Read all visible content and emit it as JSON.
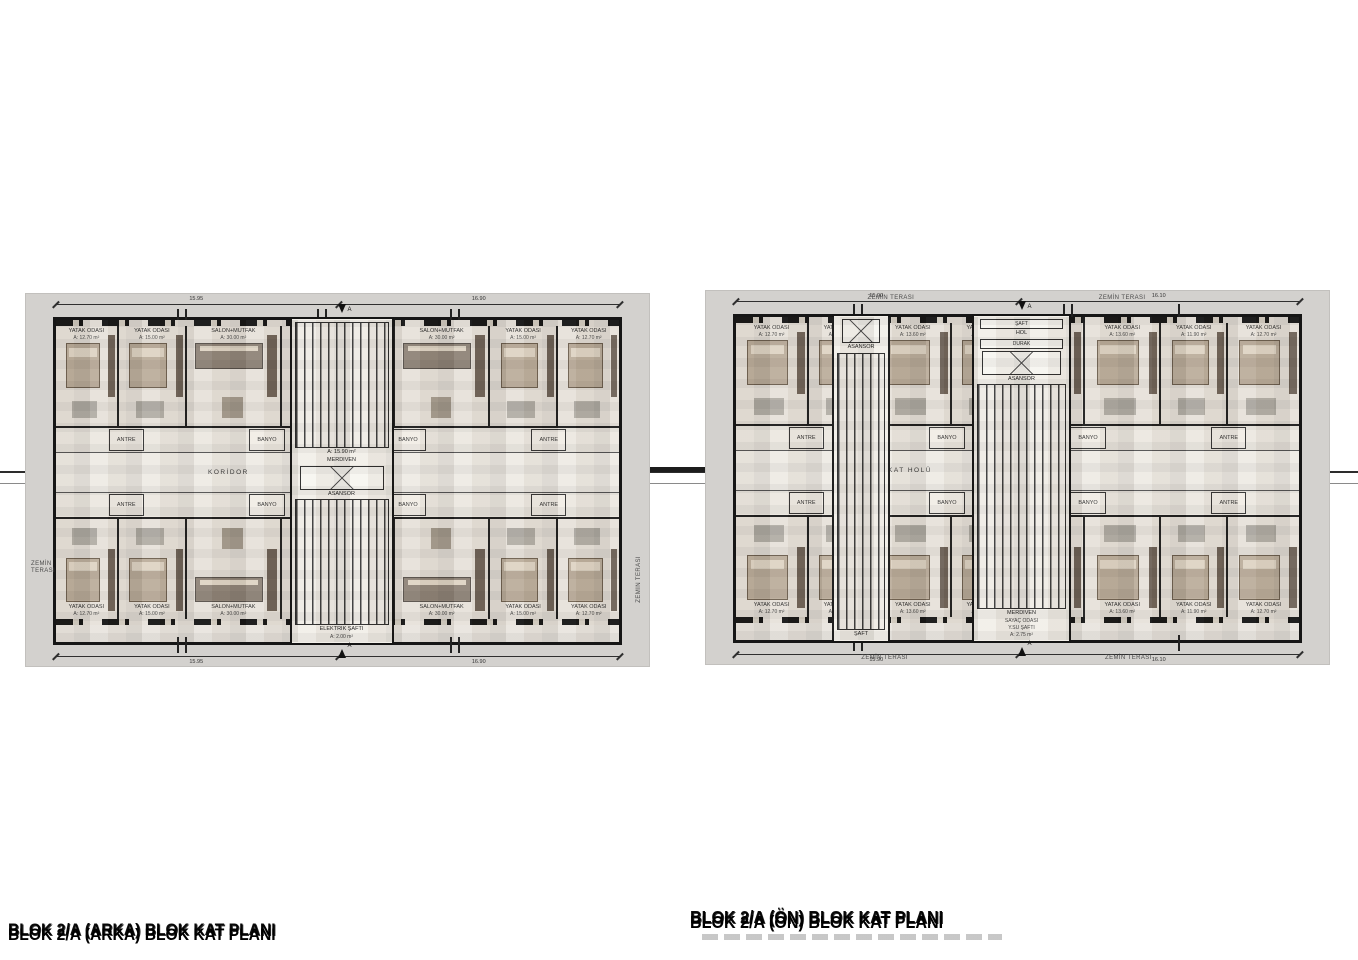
{
  "drawing": {
    "titles": {
      "left": "BLOK 2/A (ARKA) BLOK KAT PLANI",
      "right": "BLOK 2/A (ÖN) BLOK KAT PLANI"
    },
    "palette": {
      "panel_gray": "#d3d1ce",
      "building_fill": "#e9e5df",
      "wall_black": "#161616",
      "furniture_wood": "#bcae9c",
      "furniture_dark": "#6e6257",
      "rug_gray": "#a8a49c"
    }
  },
  "plan_left": {
    "corridor_label": "KORİDOR",
    "section_mark": "A",
    "terrace_left": "ZEMİN TERASI",
    "terrace_right": "ZEMİN TERASI",
    "dims_top": [
      "15.95",
      "16.90"
    ],
    "dims_bottom": [
      "15.95",
      "16.90"
    ],
    "service_top": [
      "ANTRE",
      "BANYO",
      "BANYO",
      "ANTRE"
    ],
    "service_bottom": [
      "ANTRE",
      "BANYO",
      "BANYO",
      "ANTRE"
    ],
    "core": {
      "stair": "MERDİVEN",
      "stair_area": "A: 15.90 m²",
      "elevator": "ASANSÖR",
      "shaft": "ELEKTRİK ŞAFTI",
      "shaft_area": "A: 2.00 m²"
    },
    "top_rooms": [
      {
        "name": "YATAK ODASI",
        "area": "A: 12.70 m²",
        "w": 1.05
      },
      {
        "name": "YATAK ODASI",
        "area": "A: 15.00 m²",
        "w": 1.15
      },
      {
        "name": "SALON+MUTFAK",
        "area": "A: 30.00 m²",
        "w": 1.6
      },
      {
        "name": "YATAK ODASI",
        "area": "A: 11.90 m²",
        "w": 0.95
      },
      {
        "name": "YATAK ODASI",
        "area": "A: 11.90 m²",
        "w": 0.95
      },
      {
        "name": "SALON+MUTFAK",
        "area": "A: 30.00 m²",
        "w": 1.6
      },
      {
        "name": "YATAK ODASI",
        "area": "A: 15.00 m²",
        "w": 1.15
      },
      {
        "name": "YATAK ODASI",
        "area": "A: 12.70 m²",
        "w": 1.05
      }
    ],
    "bottom_rooms": [
      {
        "name": "YATAK ODASI",
        "area": "A: 12.70 m²",
        "w": 1.05
      },
      {
        "name": "YATAK ODASI",
        "area": "A: 15.00 m²",
        "w": 1.15
      },
      {
        "name": "SALON+MUTFAK",
        "area": "A: 30.00 m²",
        "w": 1.6
      },
      {
        "name": "YATAK ODASI",
        "area": "A: 11.90 m²",
        "w": 0.95
      },
      {
        "name": "YATAK ODASI",
        "area": "A: 11.90 m²",
        "w": 0.95
      },
      {
        "name": "SALON+MUTFAK",
        "area": "A: 30.00 m²",
        "w": 1.6
      },
      {
        "name": "YATAK ODASI",
        "area": "A: 15.00 m²",
        "w": 1.15
      },
      {
        "name": "YATAK ODASI",
        "area": "A: 12.70 m²",
        "w": 1.05
      }
    ]
  },
  "plan_right": {
    "corridor_label": "KAT HOLÜ",
    "section_mark": "A",
    "terraces": {
      "top_left": "ZEMİN TERASI",
      "top_right": "ZEMİN TERASI",
      "bottom_left": "ZEMİN TERASI",
      "bottom_right": "ZEMİN TERASI"
    },
    "dims_top": [
      "15.90",
      "16.10"
    ],
    "dims_bottom": [
      "15.90",
      "16.10"
    ],
    "service_top": [
      "ANTRE",
      "BANYO",
      "BANYO",
      "ANTRE"
    ],
    "service_bottom": [
      "ANTRE",
      "BANYO",
      "BANYO",
      "ANTRE"
    ],
    "core_a": {
      "elevator": "ASANSÖR",
      "shaft": "ŞAFT"
    },
    "core_b": {
      "shaft": "ŞAFT",
      "hall": "HOL",
      "stop": "DURAK",
      "elevator": "ASANSÖR",
      "stair": "MERDİVEN",
      "meter": "SAYAÇ ODASI",
      "water": "Y.SU ŞAFTI",
      "area": "A: 2.75 m²"
    },
    "top_rooms": [
      {
        "name": "YATAK ODASI",
        "area": "A: 12.70 m²",
        "w": 1.1
      },
      {
        "name": "YATAK ODASI",
        "area": "A: 11.90 m²",
        "w": 1.0
      },
      {
        "name": "YATAK ODASI",
        "area": "A: 13.60 m²",
        "w": 1.15
      },
      {
        "name": "YATAK ODASI",
        "area": "A: 11.90 m²",
        "w": 1.0
      },
      {
        "name": "YATAK ODASI",
        "area": "A: 11.90 m²",
        "w": 1.0
      },
      {
        "name": "YATAK ODASI",
        "area": "A: 13.60 m²",
        "w": 1.15
      },
      {
        "name": "YATAK ODASI",
        "area": "A: 11.90 m²",
        "w": 1.0
      },
      {
        "name": "YATAK ODASI",
        "area": "A: 12.70 m²",
        "w": 1.1
      }
    ],
    "bottom_rooms": [
      {
        "name": "YATAK ODASI",
        "area": "A: 12.70 m²",
        "w": 1.1
      },
      {
        "name": "YATAK ODASI",
        "area": "A: 11.90 m²",
        "w": 1.0
      },
      {
        "name": "YATAK ODASI",
        "area": "A: 13.60 m²",
        "w": 1.15
      },
      {
        "name": "YATAK ODASI",
        "area": "A: 11.90 m²",
        "w": 1.0
      },
      {
        "name": "YATAK ODASI",
        "area": "A: 11.90 m²",
        "w": 1.0
      },
      {
        "name": "YATAK ODASI",
        "area": "A: 13.60 m²",
        "w": 1.15
      },
      {
        "name": "YATAK ODASI",
        "area": "A: 11.90 m²",
        "w": 1.0
      },
      {
        "name": "YATAK ODASI",
        "area": "A: 12.70 m²",
        "w": 1.1
      }
    ]
  }
}
